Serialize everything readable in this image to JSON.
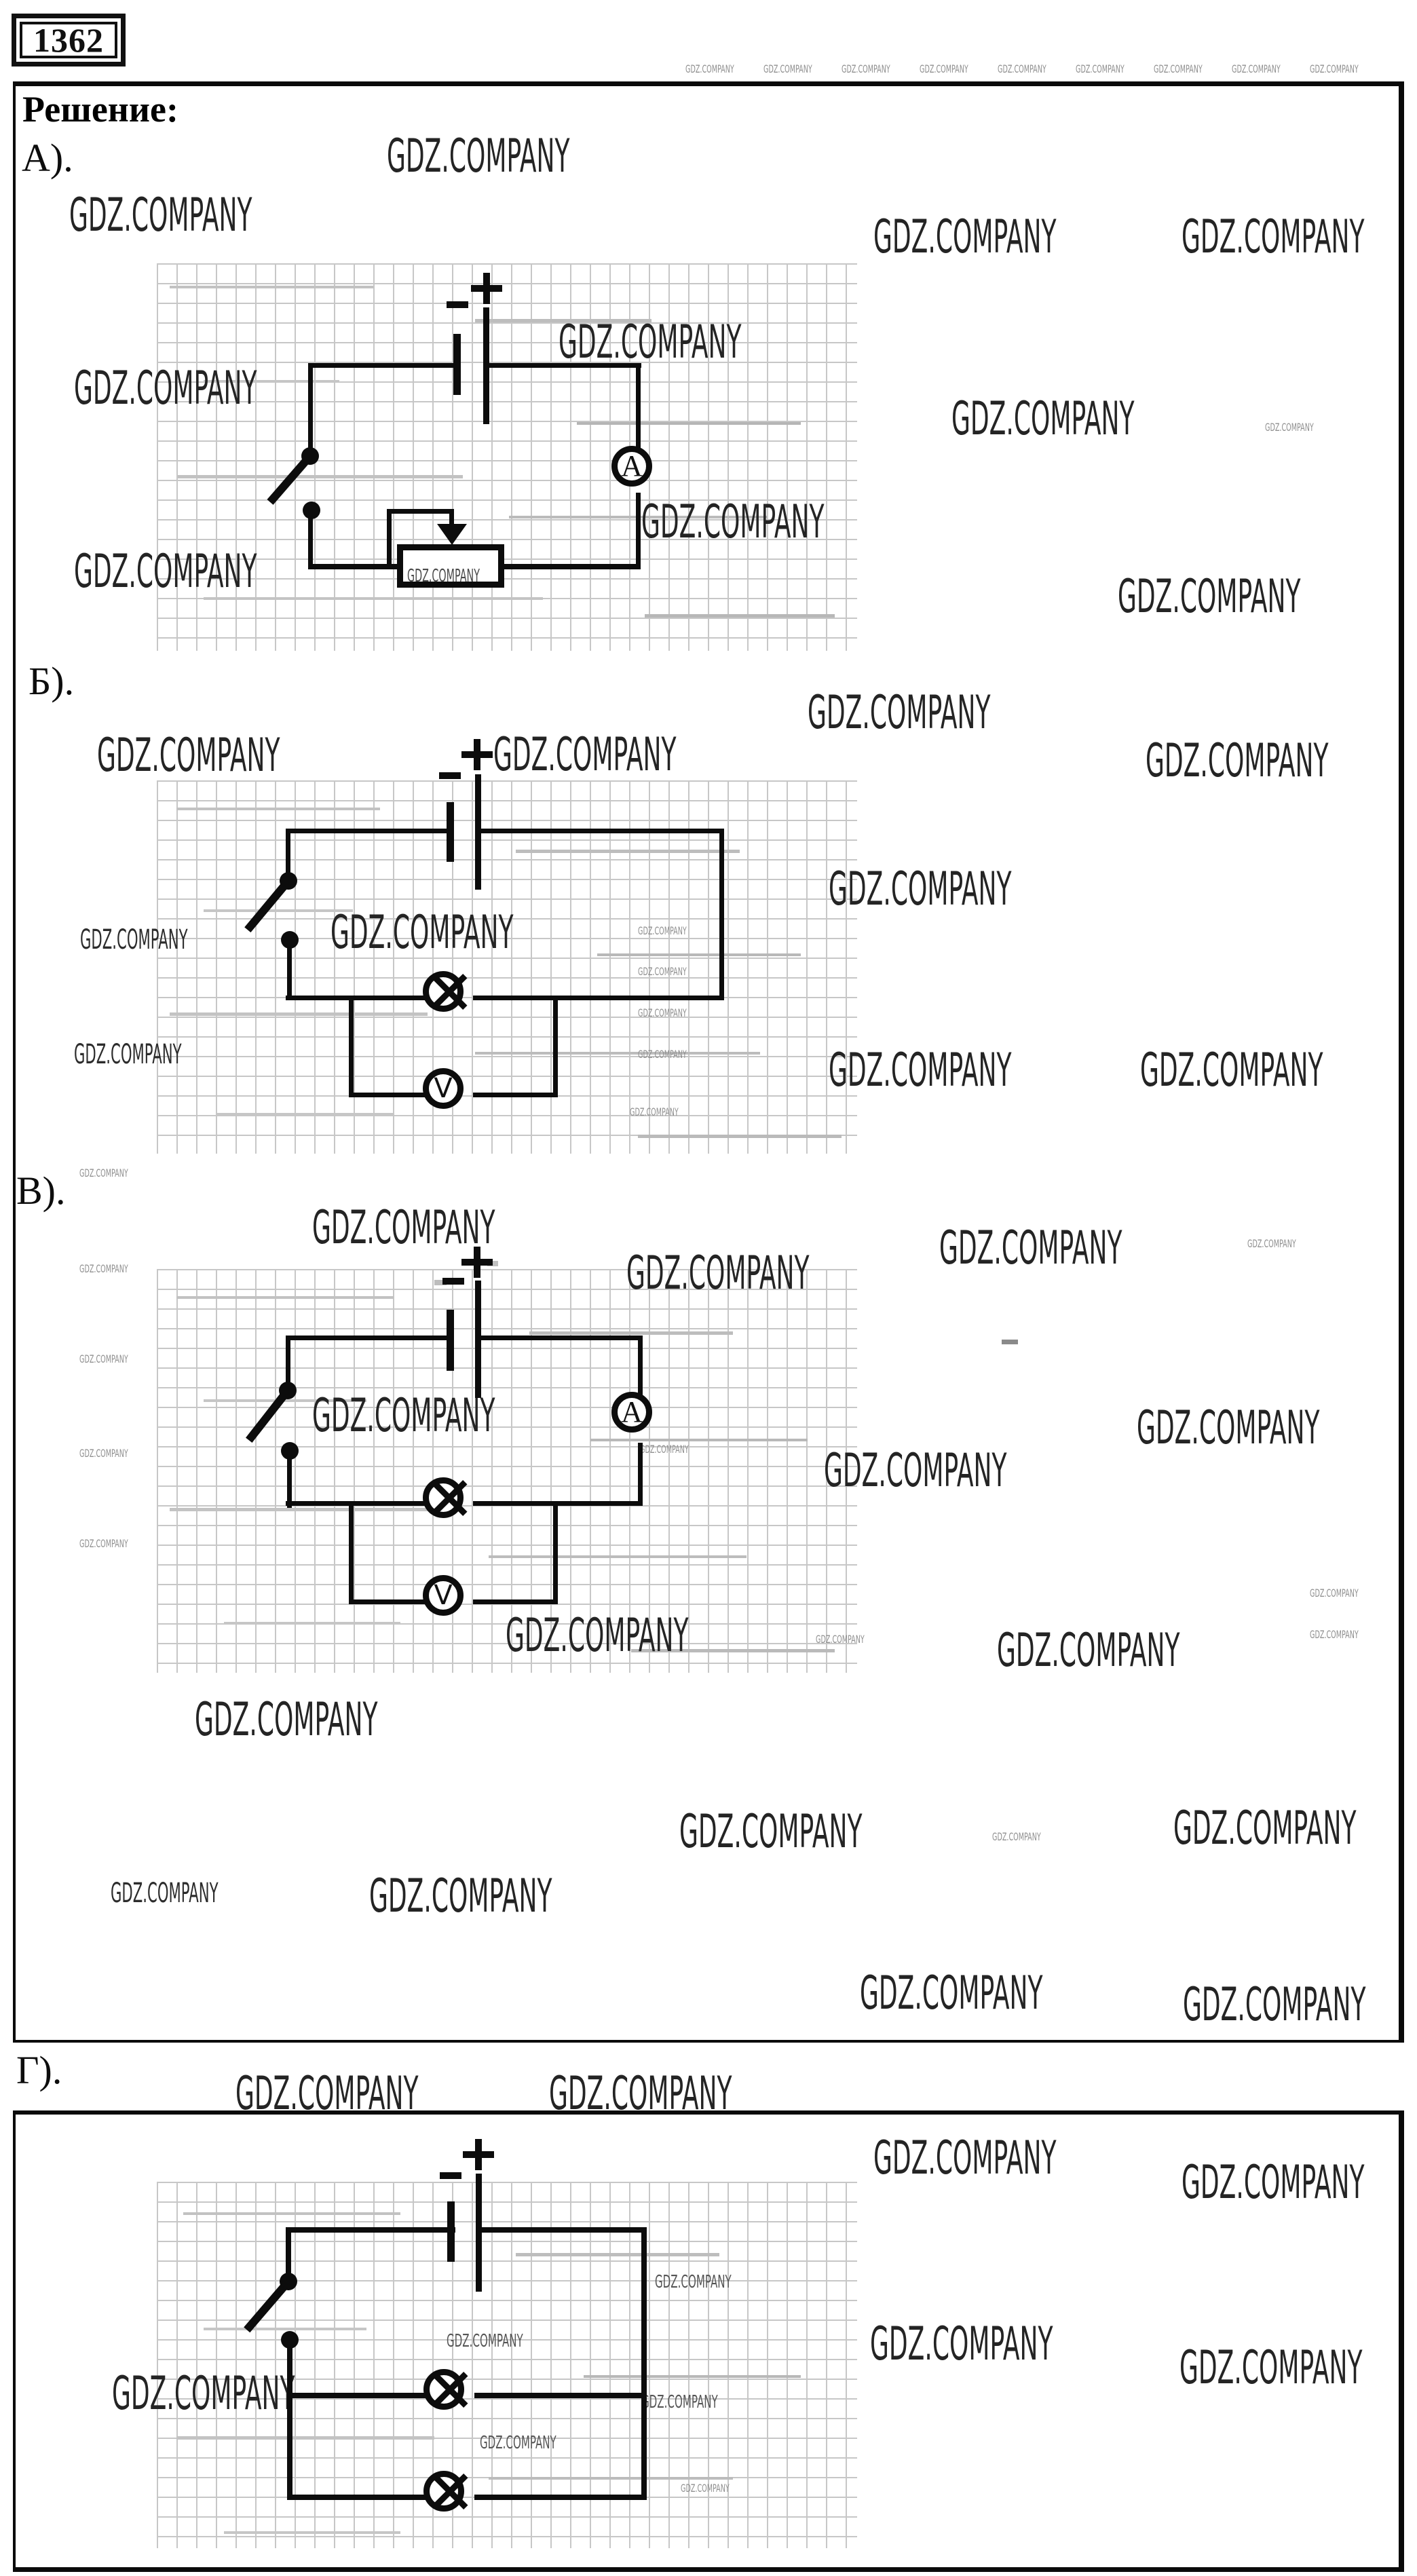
{
  "badge": {
    "number": "1362"
  },
  "header": {
    "solution_label": "Решение:"
  },
  "sections": {
    "a": {
      "label": "А)."
    },
    "b": {
      "label": "Б)."
    },
    "v": {
      "label": "В)."
    },
    "g": {
      "label": "Г)."
    }
  },
  "watermark_text": "GDZ.COMPANY",
  "components": {
    "ammeter": "A",
    "voltmeter": "V",
    "battery_plus": "+",
    "battery_minus": "−"
  }
}
